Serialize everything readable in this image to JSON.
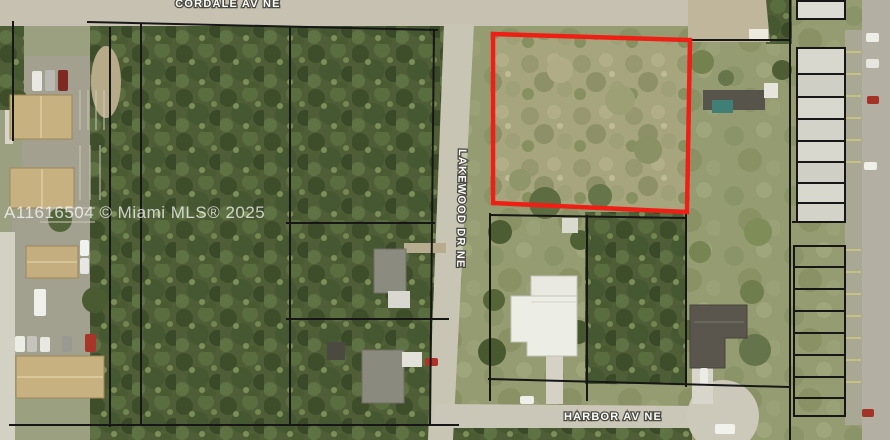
{
  "map": {
    "kind": "aerial-parcel-view",
    "streets": {
      "top": "CORDALE AV NE",
      "vertical": "LAKEWOOD DR NE",
      "bottom": "HARBOR AV NE"
    },
    "watermark": "A11616504 © Miami MLS® 2025",
    "red_parcel": {
      "points": "493,34 690,40 687,212 493,203",
      "color": "#ee1f14",
      "stroke_width": "4.5"
    },
    "boundary_color": "#171717",
    "label_colors": {
      "fill": "#ffffff",
      "outline": "#4a493f"
    }
  }
}
